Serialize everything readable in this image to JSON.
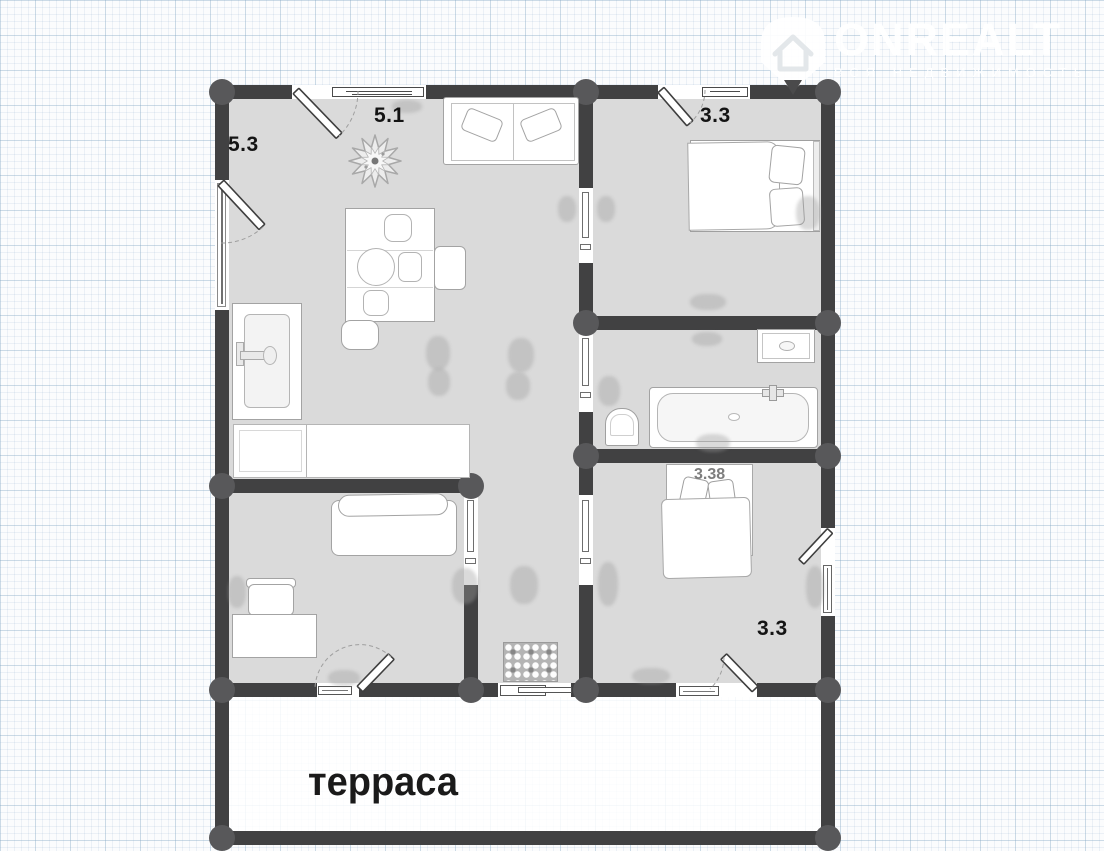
{
  "watermark": {
    "brand": "ONREALT",
    "tagline": "ВСЯ НЕДВИЖИМОСТЬ",
    "logo_icon": "house-pin-icon",
    "color": "#ffffff"
  },
  "plan": {
    "labels": {
      "living_left": "5.3",
      "living_top": "5.1",
      "bedroom_top": "3.3",
      "bed_dimension": "3.38",
      "bedroom_bottom": "3.3",
      "terrace": "терраса"
    },
    "colors": {
      "wall": "#414142",
      "floor": "#dadada",
      "corner_node": "#58585a",
      "room_label": "#141414",
      "dim_label": "#7d7d7d",
      "watermark": "#ffffff"
    }
  }
}
